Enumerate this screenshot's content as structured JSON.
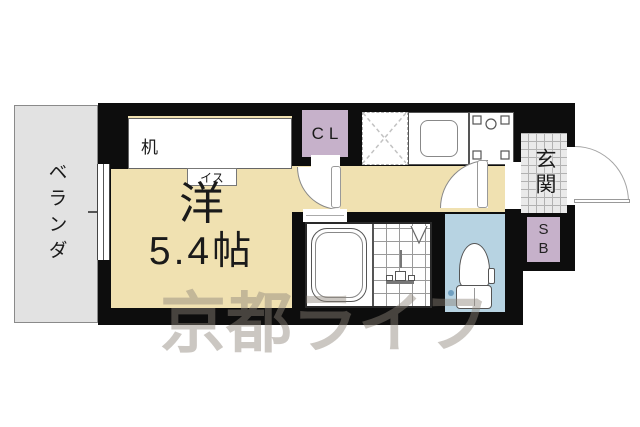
{
  "floorplan": {
    "balcony": {
      "label": "ベランダ"
    },
    "main_room": {
      "name": "洋",
      "size": "5.4帖"
    },
    "furniture": {
      "desk_label": "机",
      "chair_label": "イス"
    },
    "closet": {
      "label": "CL"
    },
    "entrance": {
      "label": "玄関"
    },
    "shoe_box": {
      "label": "SB"
    },
    "watermark": {
      "text": "京都ライフ"
    },
    "colors": {
      "wall": "#0d0d0d",
      "room_floor": "#f0e1b1",
      "balcony_floor": "#e2e2e2",
      "storage": "#c6b1ca",
      "toilet_floor": "#b7d3e2",
      "entrance_tile": "#eaeaea",
      "watermark": "#8e857a"
    }
  }
}
